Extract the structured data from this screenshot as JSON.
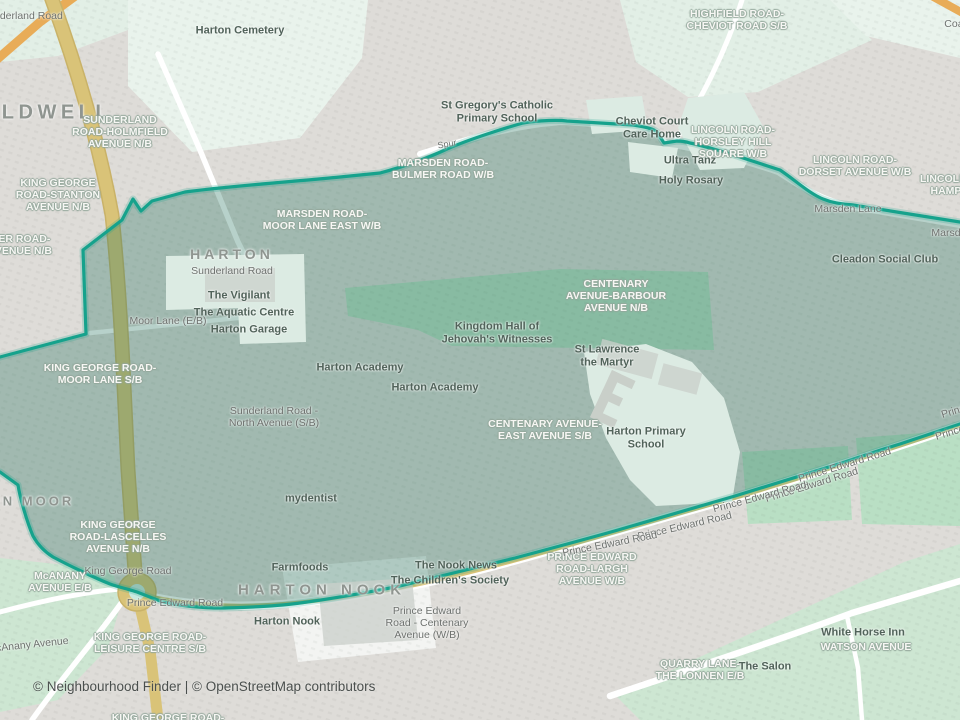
{
  "map": {
    "attribution": "© Neighbourhood Finder | © OpenStreetMap contributors",
    "colors": {
      "base": "#dedcd8",
      "open_mint": "#e9f3ec",
      "open_mint2": "#e2efe6",
      "green": "#b9dfc4",
      "green_pale": "#cde6d2",
      "white_area": "#f3f4f2",
      "pale_inner": "#dcebe3",
      "building_gray": "#c9cfc9",
      "road_tan": "#d9c378",
      "road_tan_dark": "#c9b268",
      "road_orange": "#e8ac58",
      "road_white": "#ffffff",
      "boundary": "#16a28c",
      "overlay": "#24745f",
      "roundabout_inner": "#c9e9e1",
      "label_place": "#8f9590",
      "label_poi": "#51635a",
      "label_stop": "#f7f7f4",
      "label_stop_halo": "#93a79b",
      "label_road": "#6d716e",
      "footer_text": "#4a4f4d"
    },
    "place_labels": [
      {
        "id": "place-caldwell",
        "text": "CALDWELL",
        "x": 38,
        "y": 113,
        "size": 20,
        "ls": 4.5
      },
      {
        "id": "place-harton",
        "text": "HARTON",
        "x": 232,
        "y": 255,
        "size": 14,
        "ls": 4
      },
      {
        "id": "place-harton-moor",
        "text": "HARTON MOOR",
        "x": 8,
        "y": 502,
        "size": 13,
        "ls": 3
      },
      {
        "id": "place-harton-nook",
        "text": "HARTON NOOK",
        "x": 322,
        "y": 590,
        "size": 15,
        "ls": 5
      }
    ],
    "stop_labels": [
      {
        "id": "stop-highfield-cheviot",
        "lines": [
          "HIGHFIELD ROAD-",
          "CHEVIOT ROAD S/B"
        ],
        "x": 737,
        "y": 21
      },
      {
        "id": "stop-sunderland-holmfield",
        "lines": [
          "SUNDERLAND",
          "ROAD-HOLMFIELD",
          "AVENUE N/B"
        ],
        "x": 120,
        "y": 133
      },
      {
        "id": "stop-king-george-stanton",
        "lines": [
          "KING GEORGE",
          "ROAD-STANTON",
          "AVENUE N/B"
        ],
        "x": 58,
        "y": 196
      },
      {
        "id": "stop-bulmer-road",
        "lines": [
          "MER ROAD-",
          "AVENUE N/B"
        ],
        "x": 20,
        "y": 246
      },
      {
        "id": "stop-lincoln-horsley-hill",
        "lines": [
          "LINCOLN ROAD-",
          "HORSLEY HILL",
          "SQUARE W/B"
        ],
        "x": 733,
        "y": 143
      },
      {
        "id": "stop-lincoln-dorset",
        "lines": [
          "LINCOLN ROAD-",
          "DORSET AVENUE W/B"
        ],
        "x": 855,
        "y": 167
      },
      {
        "id": "stop-lincoln-hampshire",
        "lines": [
          "LINCOLN ROAD-",
          "HAMPSHIRE"
        ],
        "x": 962,
        "y": 186
      },
      {
        "id": "stop-marsden-bulmer",
        "lines": [
          "MARSDEN ROAD-",
          "BULMER ROAD W/B"
        ],
        "x": 443,
        "y": 170
      },
      {
        "id": "stop-marsden-moor-lane",
        "lines": [
          "MARSDEN ROAD-",
          "MOOR LANE EAST W/B"
        ],
        "x": 322,
        "y": 221
      },
      {
        "id": "stop-centenary-barbour",
        "lines": [
          "CENTENARY",
          "AVENUE-BARBOUR",
          "AVENUE N/B"
        ],
        "x": 616,
        "y": 297
      },
      {
        "id": "stop-king-george-moor-lane",
        "lines": [
          "KING GEORGE ROAD-",
          "MOOR LANE S/B"
        ],
        "x": 100,
        "y": 375
      },
      {
        "id": "stop-centenary-east",
        "lines": [
          "CENTENARY AVENUE-",
          "EAST AVENUE S/B"
        ],
        "x": 545,
        "y": 431
      },
      {
        "id": "stop-king-george-lascelles",
        "lines": [
          "KING GEORGE",
          "ROAD-LASCELLES",
          "AVENUE N/B"
        ],
        "x": 118,
        "y": 538
      },
      {
        "id": "stop-mcanany-avenue",
        "lines": [
          "McANANY",
          "AVENUE E/B"
        ],
        "x": 60,
        "y": 583
      },
      {
        "id": "stop-prince-edward-largh",
        "lines": [
          "PRINCE EDWARD",
          "ROAD-LARGH",
          "AVENUE W/B"
        ],
        "x": 592,
        "y": 570
      },
      {
        "id": "stop-king-george-leisure",
        "lines": [
          "KING GEORGE ROAD-",
          "LEISURE CENTRE S/B"
        ],
        "x": 150,
        "y": 644
      },
      {
        "id": "stop-quarry-lane-lonnen",
        "lines": [
          "QUARRY LANE-",
          "THE LONNEN E/B"
        ],
        "x": 700,
        "y": 671
      },
      {
        "id": "stop-watson-avenue",
        "lines": [
          "WATSON AVENUE"
        ],
        "x": 866,
        "y": 648
      },
      {
        "id": "stop-king-george-bottom",
        "lines": [
          "KING GEORGE ROAD-"
        ],
        "x": 168,
        "y": 719
      }
    ],
    "poi_labels": [
      {
        "id": "poi-harton-cemetery",
        "text": "Harton Cemetery",
        "x": 240,
        "y": 31
      },
      {
        "id": "poi-st-gregorys",
        "lines": [
          "St Gregory's Catholic",
          "Primary School"
        ],
        "x": 497,
        "y": 112
      },
      {
        "id": "poi-cheviot-court-care-home",
        "lines": [
          "Cheviot Court",
          "Care Home"
        ],
        "x": 652,
        "y": 128
      },
      {
        "id": "poi-ultra-tanz",
        "text": "Ultra Tanz",
        "x": 690,
        "y": 161
      },
      {
        "id": "poi-holy-rosary",
        "text": "Holy Rosary",
        "x": 691,
        "y": 181
      },
      {
        "id": "poi-cleadon-social-club",
        "text": "Cleadon Social Club",
        "x": 885,
        "y": 260
      },
      {
        "id": "poi-the-vigilant",
        "text": "The Vigilant",
        "x": 239,
        "y": 296
      },
      {
        "id": "poi-the-aquatic-centre",
        "text": "The Aquatic Centre",
        "x": 244,
        "y": 313
      },
      {
        "id": "poi-harton-garage",
        "text": "Harton Garage",
        "x": 249,
        "y": 330
      },
      {
        "id": "poi-kingdom-hall",
        "lines": [
          "Kingdom Hall of",
          "Jehovah's Witnesses"
        ],
        "x": 497,
        "y": 333
      },
      {
        "id": "poi-st-lawrence",
        "lines": [
          "St Lawrence",
          "the Martyr"
        ],
        "x": 607,
        "y": 356
      },
      {
        "id": "poi-harton-academy-1",
        "text": "Harton Academy",
        "x": 360,
        "y": 368
      },
      {
        "id": "poi-harton-academy-2",
        "text": "Harton Academy",
        "x": 435,
        "y": 388
      },
      {
        "id": "poi-harton-primary",
        "lines": [
          "Harton Primary",
          "School"
        ],
        "x": 646,
        "y": 438
      },
      {
        "id": "poi-mydentist",
        "text": "mydentist",
        "x": 311,
        "y": 499
      },
      {
        "id": "poi-farmfoods",
        "text": "Farmfoods",
        "x": 300,
        "y": 568
      },
      {
        "id": "poi-the-nook-news",
        "text": "The Nook News",
        "x": 456,
        "y": 566
      },
      {
        "id": "poi-childrens-society",
        "text": "The Children's Society",
        "x": 450,
        "y": 581
      },
      {
        "id": "poi-harton-nook",
        "text": "Harton Nook",
        "x": 287,
        "y": 622
      },
      {
        "id": "poi-white-horse-inn",
        "text": "White Horse Inn",
        "x": 863,
        "y": 633
      },
      {
        "id": "poi-the-salon",
        "text": "The Salon",
        "x": 765,
        "y": 667
      }
    ],
    "road_labels": [
      {
        "id": "road-sunderland-top",
        "text": "Sunderland Road",
        "x": 22,
        "y": 17
      },
      {
        "id": "road-coast",
        "text": "Coast Road",
        "x": 972,
        "y": 25
      },
      {
        "id": "road-spur",
        "text": "Spur",
        "x": 447,
        "y": 144,
        "size": 9,
        "rot": -10
      },
      {
        "id": "road-marsden-lane",
        "text": "Marsden Lane",
        "x": 848,
        "y": 210
      },
      {
        "id": "road-marsden-lane-edge",
        "text": "Marsden Lane",
        "x": 965,
        "y": 234
      },
      {
        "id": "road-sunderland",
        "text": "Sunderland Road",
        "x": 232,
        "y": 272
      },
      {
        "id": "road-moor-lane",
        "text": "Moor Lane (E/B)",
        "x": 168,
        "y": 322
      },
      {
        "id": "road-sunderland-north-avenue",
        "lines": [
          "Sunderland Road -",
          "North Avenue (S/B)"
        ],
        "x": 274,
        "y": 418
      },
      {
        "id": "road-prince-edward-1",
        "text": "Prince Edward Road",
        "x": 845,
        "y": 466,
        "rot": -17
      },
      {
        "id": "road-prince-edward-2",
        "text": "Prince Edward Road",
        "x": 812,
        "y": 486,
        "rot": -17
      },
      {
        "id": "road-prince-edward-3",
        "text": "Prince Edward Road",
        "x": 760,
        "y": 498,
        "rot": -15
      },
      {
        "id": "road-prince-edward-4",
        "text": "Prince Edward Road",
        "x": 685,
        "y": 527,
        "rot": -13
      },
      {
        "id": "road-prince-edward-5",
        "text": "Prince Edward Road",
        "x": 610,
        "y": 545,
        "rot": -11
      },
      {
        "id": "road-prince-edward-edge-1",
        "text": "Prince Edward Road",
        "x": 988,
        "y": 402,
        "rot": -17
      },
      {
        "id": "road-prince-edward-edge-2",
        "text": "Prince Edward Road",
        "x": 982,
        "y": 424,
        "rot": -17
      },
      {
        "id": "road-king-george",
        "text": "King George Road",
        "x": 128,
        "y": 572
      },
      {
        "id": "road-prince-edward-west",
        "text": "Prince Edward Road",
        "x": 175,
        "y": 604
      },
      {
        "id": "road-prince-edward-centenary",
        "lines": [
          "Prince Edward",
          "Road - Centenary",
          "Avenue (W/B)"
        ],
        "x": 427,
        "y": 624
      },
      {
        "id": "road-mcanany-avenue",
        "text": "McAnany Avenue",
        "x": 28,
        "y": 646,
        "rot": -6
      }
    ]
  }
}
